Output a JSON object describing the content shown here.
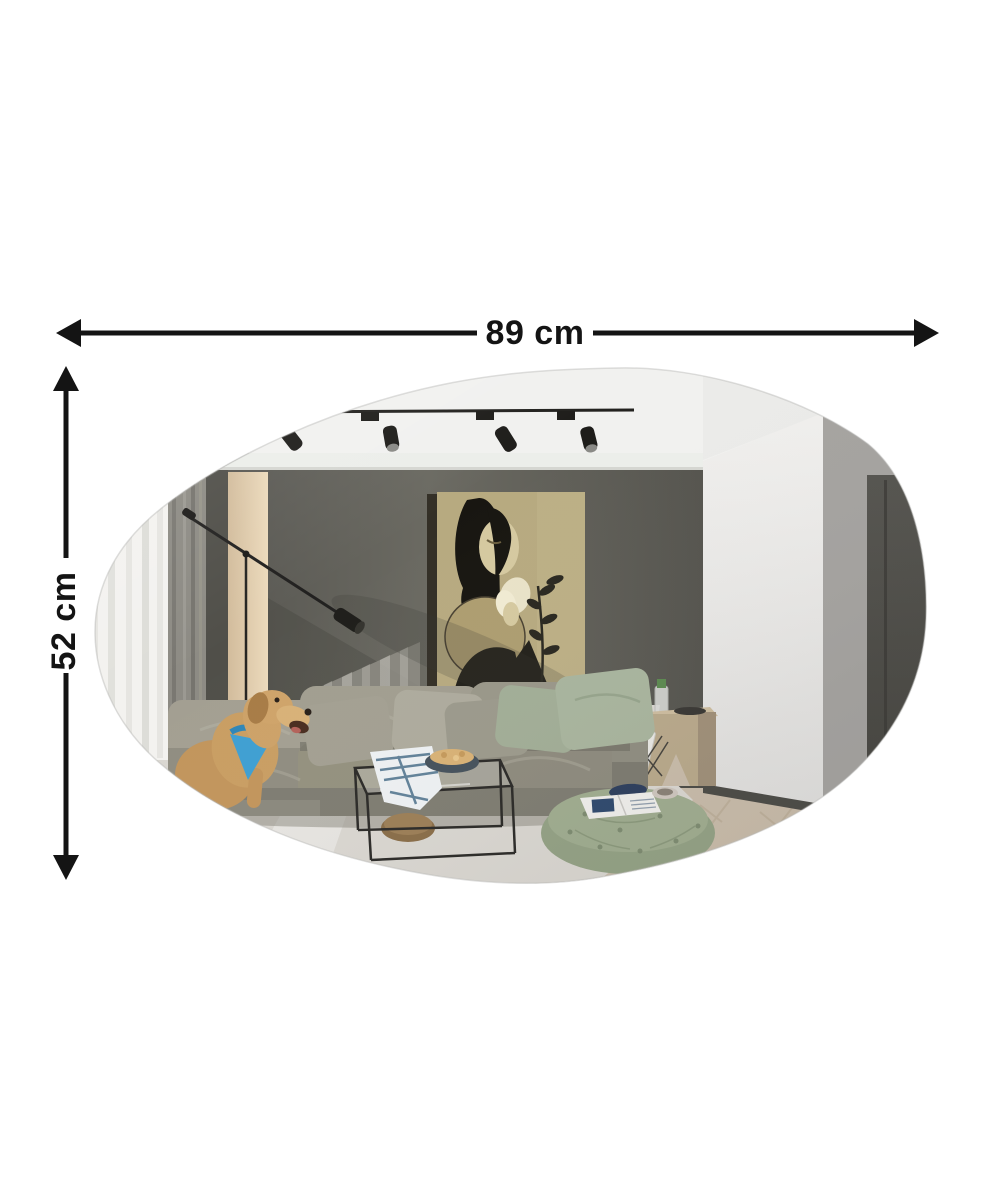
{
  "page": {
    "type": "product-dimension-image",
    "background": "#ffffff"
  },
  "product": {
    "name": "asymmetric frameless mirror",
    "shape": "organic pebble / irregular oval",
    "reflection_scene": "modern living room: white ceiling with black track lighting, dark grey feature wall with portrait artwork of a woman holding a flower, sheer and grey curtains, wood wall panel, black articulated floor lamp, olive-grey sectional sofa with sage pillows, golden retriever with blue bandana, black wireframe glass coffee table, green tufted pouf with magazine, light wood side table with bottle"
  },
  "dimensions": {
    "width": {
      "label": "89 cm",
      "value": 89,
      "unit": "cm"
    },
    "height": {
      "label": "52 cm",
      "value": 52,
      "unit": "cm"
    }
  },
  "style": {
    "arrow_color": "#141414",
    "label_color": "#141414",
    "palette": {
      "ceiling": "#f1f1ef",
      "back_wall": "#5b5a54",
      "right_wall_dark": "#4e4d48",
      "white_column": "#e9e8e6",
      "grey_band": "#a5a3a0",
      "curtain_sheer": "#f3f2ef",
      "curtain_grey": "#8d8b84",
      "wood_panel": "#dcc7a6",
      "art_background": "#b7aa80",
      "sofa": "#95928a",
      "pillow_sage": "#a7b39c",
      "carpet": "#dad7d1",
      "floor_wood": "#c9bcaa",
      "pouf": "#96a487",
      "dog": "#c99e63",
      "bandana": "#3f9fd2",
      "track_light": "#1e1d1a"
    }
  }
}
